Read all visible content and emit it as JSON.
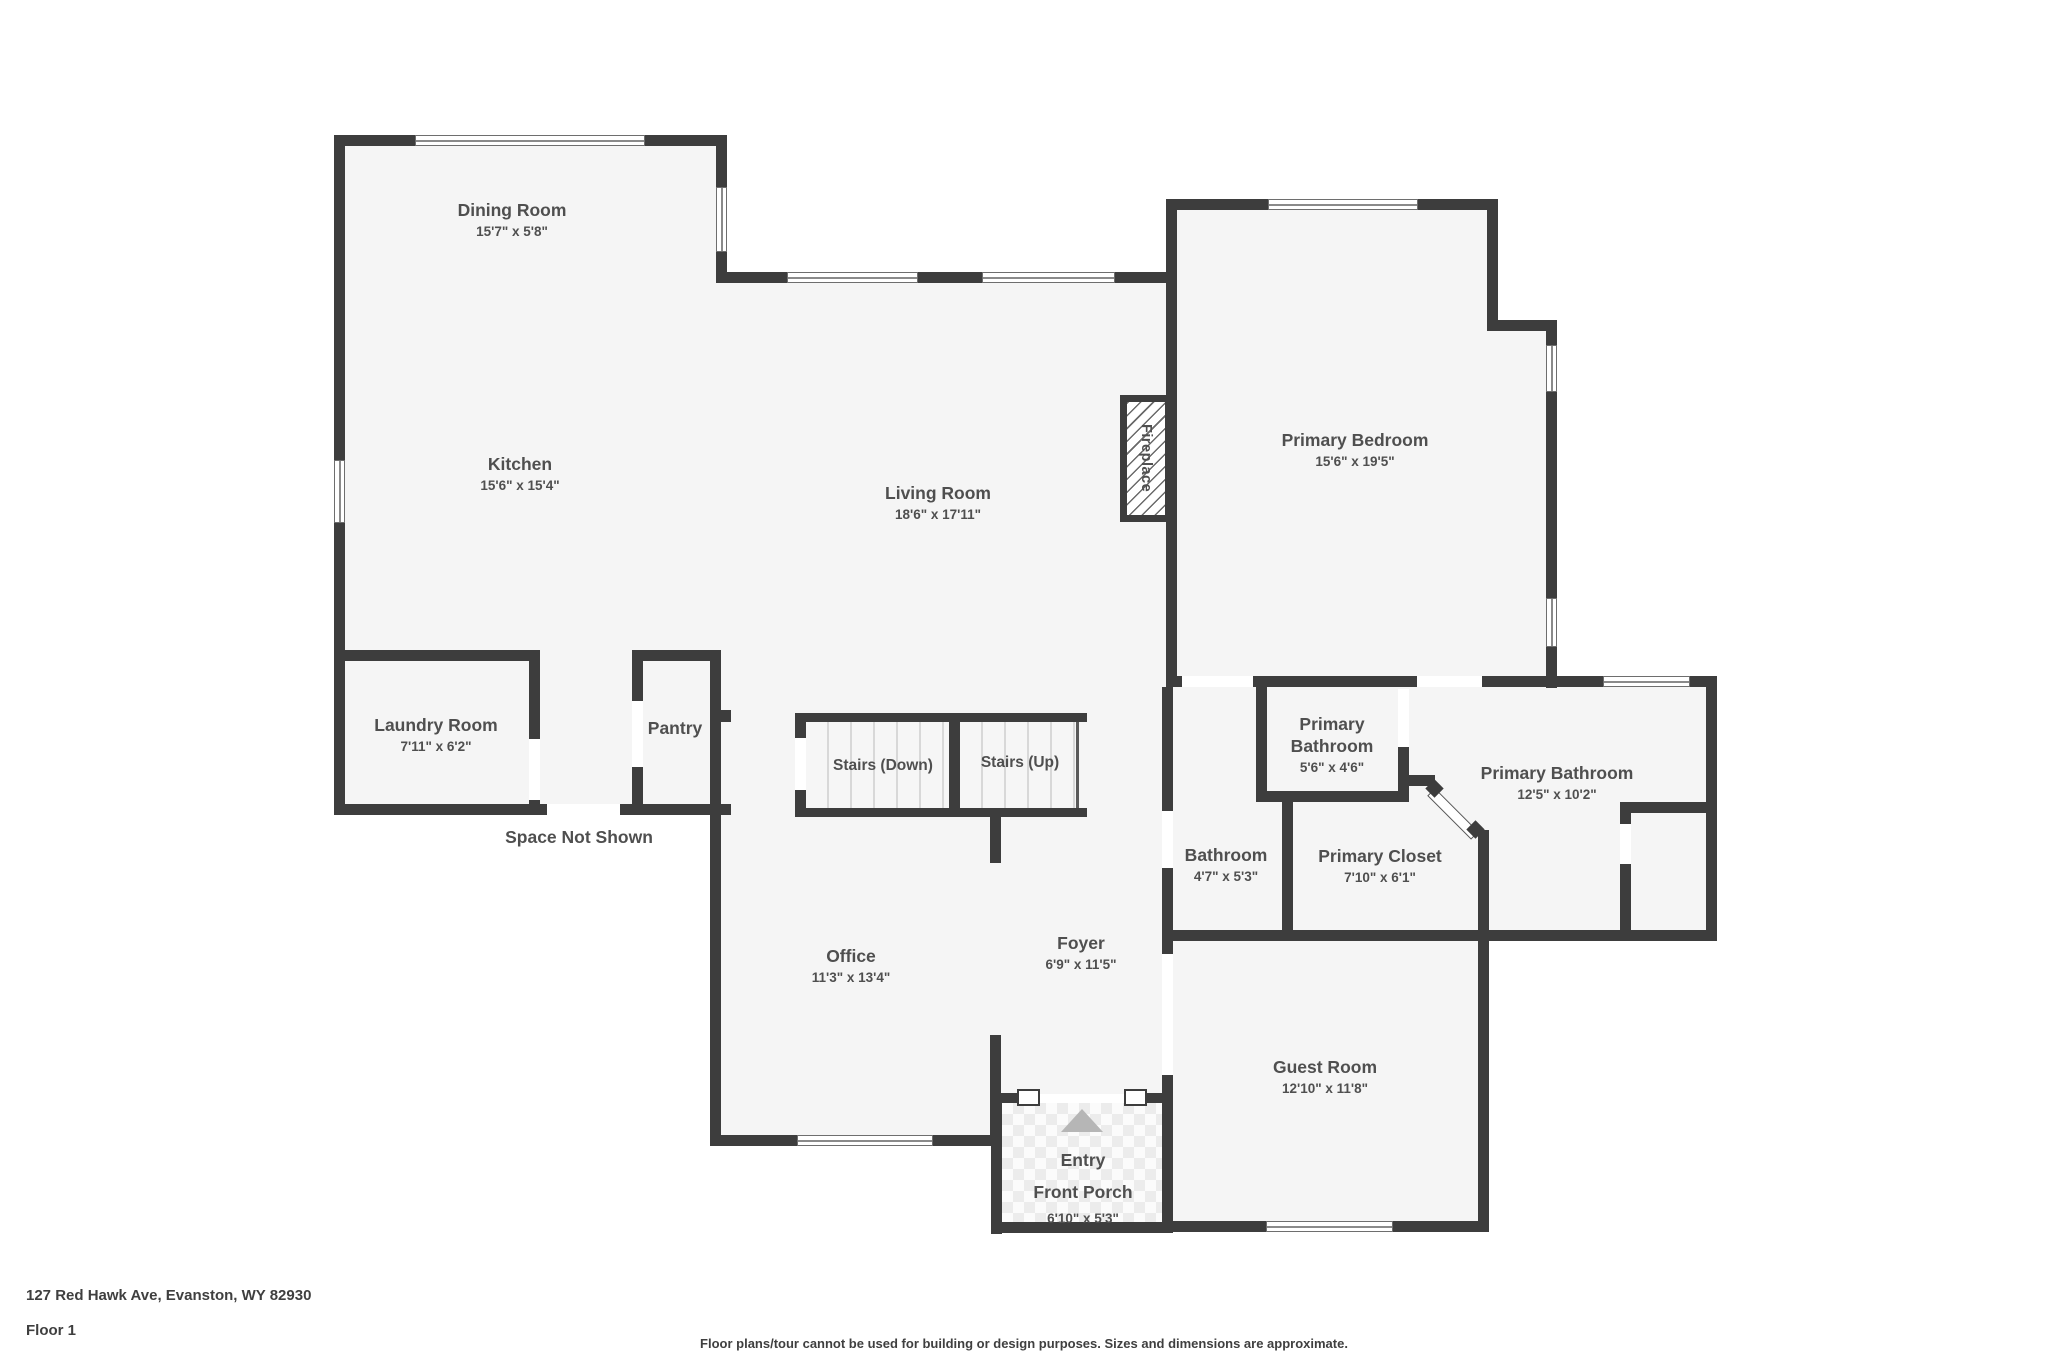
{
  "title": "Floor plan",
  "colors": {
    "wall": "#3d3d3d",
    "floor": "#f5f5f5",
    "text": "#4f4f4f",
    "line": "#8a8a8a",
    "porch_arrow": "#b6b6b6",
    "tile": "#ececec"
  },
  "rooms": [
    {
      "name": "Dining Room",
      "dims": "15'7\" x 5'8\""
    },
    {
      "name": "Kitchen",
      "dims": "15'6\" x 15'4\""
    },
    {
      "name": "Living Room",
      "dims": "18'6\" x 17'11\""
    },
    {
      "name": "Primary Bedroom",
      "dims": "15'6\" x 19'5\""
    },
    {
      "name": "Laundry Room",
      "dims": "7'11\" x 6'2\""
    },
    {
      "name": "Pantry",
      "dims": ""
    },
    {
      "name": "Stairs (Down)",
      "dims": ""
    },
    {
      "name": "Stairs (Up)",
      "dims": ""
    },
    {
      "name": "Primary\nBathroom",
      "dims": "5'6\" x 4'6\""
    },
    {
      "name": "Primary Bathroom",
      "dims": "12'5\" x 10'2\""
    },
    {
      "name": "Bathroom",
      "dims": "4'7\" x 5'3\""
    },
    {
      "name": "Primary Closet",
      "dims": "7'10\" x 6'1\""
    },
    {
      "name": "Office",
      "dims": "11'3\" x 13'4\""
    },
    {
      "name": "Foyer",
      "dims": "6'9\" x 11'5\""
    },
    {
      "name": "Guest Room",
      "dims": "12'10\" x 11'8\""
    },
    {
      "name": "Entry\nFront Porch",
      "dims": "6'10\" x 5'3\""
    }
  ],
  "annotations": {
    "fireplace": "Fireplace",
    "space_not_shown": "Space Not Shown"
  },
  "footer": {
    "address": "127 Red Hawk Ave, Evanston, WY 82930",
    "floor": "Floor 1",
    "disclaimer": "Floor plans/tour cannot be used for building or design purposes. Sizes and dimensions are approximate."
  }
}
